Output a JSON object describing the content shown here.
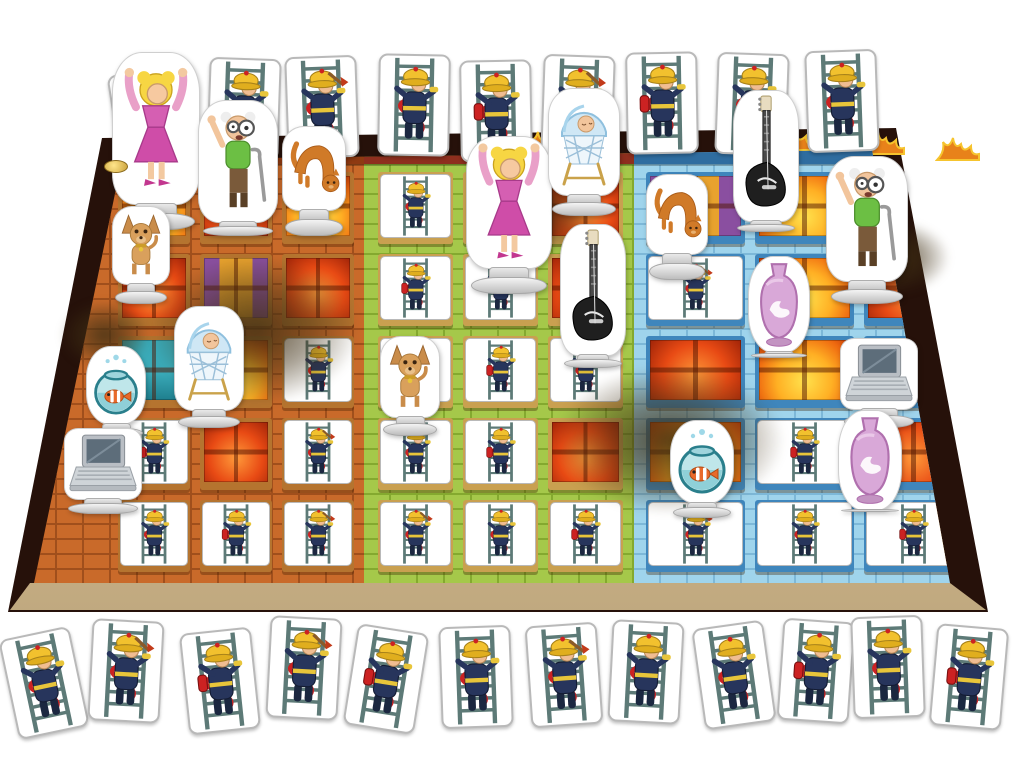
{
  "scene": {
    "kind": "board-game-photo",
    "game_theme": "fire-brigade-ladder-rescue",
    "background_color": "#ffffff"
  },
  "colors": {
    "board_border": "#26110a",
    "sidewalk": "#cbb48a",
    "card_background": "#ffffff",
    "card_border": "#b9b9b9",
    "ladder": "#5d7a77",
    "fireman_uniform": "#27355c",
    "fireman_helmet": "#f2c12e",
    "hose_red": "#cc2222",
    "token_base": "#d6d6d6",
    "smoke": "#403014"
  },
  "board": {
    "outline": "trapezoid in perspective, dark brown border with flames along the top edge",
    "coin": {
      "x": 104,
      "y": 160
    }
  },
  "buildings": [
    {
      "id": "orange-building",
      "facade": "#c96a2a",
      "mortar": "#a04f1c",
      "frame": "#b5742f",
      "roof": "#8e3a12",
      "box": {
        "x": 30,
        "w": 334,
        "colsLeft": 88
      },
      "cells": [
        [
          "fg",
          "fr",
          "fg"
        ],
        [
          "fr",
          "pu",
          "fr"
        ],
        [
          "te",
          "fg",
          "card"
        ],
        [
          "card",
          "fr",
          "card"
        ],
        [
          "card",
          "card",
          "card"
        ]
      ]
    },
    {
      "id": "green-building",
      "facade": "#a5c84a",
      "mortar": "#84a92f",
      "frame": "#c9a050",
      "roof": "#8e2f1e",
      "box": {
        "x": 364,
        "w": 270,
        "colsLeft": 14
      },
      "cells": [
        [
          "card",
          "fg",
          "fr"
        ],
        [
          "card",
          "card",
          "fr"
        ],
        [
          "card",
          "card",
          "card"
        ],
        [
          "card",
          "card",
          "fr"
        ],
        [
          "card",
          "card",
          "card"
        ]
      ]
    },
    {
      "id": "blue-building",
      "facade": "#9fd4ec",
      "mortar": "#7db8d8",
      "frame": "#3f86bc",
      "roof": "#2f6da0",
      "box": {
        "x": 634,
        "w": 340,
        "colsLeft": 12
      },
      "cells": [
        [
          "pu",
          "fg",
          "fr"
        ],
        [
          "card",
          "fg",
          "fr"
        ],
        [
          "fr",
          "fg",
          "card"
        ],
        [
          "fg",
          "card",
          "fr"
        ],
        [
          "card",
          "card",
          "card"
        ]
      ]
    }
  ],
  "grid": {
    "rows_y": [
      172,
      254,
      336,
      418,
      500
    ],
    "row_h": 72,
    "col_gap": 10,
    "cols_per_building": 3
  },
  "card_size": {
    "w": 68,
    "h": 98,
    "board_variant_cycle": [
      "hose",
      "extinguisher",
      "axe"
    ]
  },
  "top_cards": [
    {
      "x": 114,
      "y": 70,
      "r": -9,
      "v": "hose"
    },
    {
      "x": 208,
      "y": 58,
      "r": 2,
      "v": "extinguisher"
    },
    {
      "x": 286,
      "y": 56,
      "r": -2,
      "v": "axe"
    },
    {
      "x": 378,
      "y": 54,
      "r": 1,
      "v": "hose"
    },
    {
      "x": 460,
      "y": 60,
      "r": -1,
      "v": "extinguisher"
    },
    {
      "x": 542,
      "y": 55,
      "r": 2,
      "v": "axe"
    },
    {
      "x": 626,
      "y": 52,
      "r": -1,
      "v": "extinguisher"
    },
    {
      "x": 716,
      "y": 53,
      "r": 2,
      "v": "hose"
    },
    {
      "x": 806,
      "y": 50,
      "r": -2,
      "v": "hose"
    }
  ],
  "bottom_cards": [
    {
      "x": 8,
      "y": 632,
      "r": -12,
      "v": "hose"
    },
    {
      "x": 90,
      "y": 620,
      "r": 3,
      "v": "axe"
    },
    {
      "x": 184,
      "y": 630,
      "r": -6,
      "v": "extinguisher"
    },
    {
      "x": 268,
      "y": 617,
      "r": 3,
      "v": "axe"
    },
    {
      "x": 350,
      "y": 628,
      "r": 9,
      "v": "extinguisher"
    },
    {
      "x": 440,
      "y": 626,
      "r": -2,
      "v": "hose"
    },
    {
      "x": 528,
      "y": 624,
      "r": -4,
      "v": "axe"
    },
    {
      "x": 610,
      "y": 621,
      "r": 3,
      "v": "hose"
    },
    {
      "x": 698,
      "y": 624,
      "r": -8,
      "v": "hose"
    },
    {
      "x": 780,
      "y": 620,
      "r": 4,
      "v": "extinguisher"
    },
    {
      "x": 852,
      "y": 616,
      "r": -2,
      "v": "hose"
    },
    {
      "x": 933,
      "y": 626,
      "r": 5,
      "v": "extinguisher"
    }
  ],
  "tokens": [
    {
      "type": "woman",
      "name": "blonde-woman-standee",
      "x": 112,
      "y": 52,
      "w": 88,
      "h": 178
    },
    {
      "type": "grandpa",
      "name": "grandpa-standee",
      "x": 198,
      "y": 100,
      "w": 80,
      "h": 136
    },
    {
      "type": "cat",
      "name": "cat-standee",
      "x": 282,
      "y": 126,
      "w": 64,
      "h": 110
    },
    {
      "type": "dog",
      "name": "dog-standee",
      "x": 112,
      "y": 206,
      "w": 58,
      "h": 98
    },
    {
      "type": "bassinet",
      "name": "baby-bassinet-standee",
      "x": 174,
      "y": 306,
      "w": 70,
      "h": 122
    },
    {
      "type": "fishbowl",
      "name": "fishbowl-standee",
      "x": 86,
      "y": 346,
      "w": 60,
      "h": 92
    },
    {
      "type": "laptop",
      "name": "laptop-standee",
      "x": 64,
      "y": 428,
      "w": 78,
      "h": 86
    },
    {
      "type": "woman",
      "name": "blonde-woman-standee",
      "x": 466,
      "y": 136,
      "w": 86,
      "h": 158
    },
    {
      "type": "bassinet",
      "name": "baby-bassinet-standee",
      "x": 548,
      "y": 88,
      "w": 72,
      "h": 128
    },
    {
      "type": "dog",
      "name": "dog-standee",
      "x": 380,
      "y": 336,
      "w": 60,
      "h": 100
    },
    {
      "type": "guitar",
      "name": "electric-guitar-standee",
      "x": 560,
      "y": 224,
      "w": 66,
      "h": 144
    },
    {
      "type": "guitar",
      "name": "electric-guitar-standee",
      "x": 733,
      "y": 90,
      "w": 66,
      "h": 142
    },
    {
      "type": "cat",
      "name": "cat-standee",
      "x": 646,
      "y": 174,
      "w": 62,
      "h": 106
    },
    {
      "type": "grandpa",
      "name": "grandpa-standee",
      "x": 826,
      "y": 156,
      "w": 82,
      "h": 148
    },
    {
      "type": "vase",
      "name": "vase-standee",
      "x": 748,
      "y": 256,
      "w": 62,
      "h": 102
    },
    {
      "type": "laptop",
      "name": "laptop-standee",
      "x": 840,
      "y": 338,
      "w": 78,
      "h": 90
    },
    {
      "type": "fishbowl",
      "name": "fishbowl-standee",
      "x": 670,
      "y": 420,
      "w": 64,
      "h": 98
    },
    {
      "type": "vase",
      "name": "vase-standee",
      "x": 838,
      "y": 410,
      "w": 64,
      "h": 102
    }
  ],
  "smoke": [
    {
      "x": 150,
      "y": 255,
      "w": 210,
      "h": 150
    },
    {
      "x": 470,
      "y": 165,
      "w": 130,
      "h": 90
    },
    {
      "x": 555,
      "y": 365,
      "w": 230,
      "h": 150
    },
    {
      "x": 835,
      "y": 220,
      "w": 115,
      "h": 75
    },
    {
      "x": 60,
      "y": 300,
      "w": 90,
      "h": 70
    }
  ],
  "flames": [
    {
      "x": 300,
      "y": 128
    },
    {
      "x": 520,
      "y": 126
    },
    {
      "x": 640,
      "y": 124
    },
    {
      "x": 770,
      "y": 122
    },
    {
      "x": 860,
      "y": 126
    },
    {
      "x": 935,
      "y": 132
    }
  ]
}
